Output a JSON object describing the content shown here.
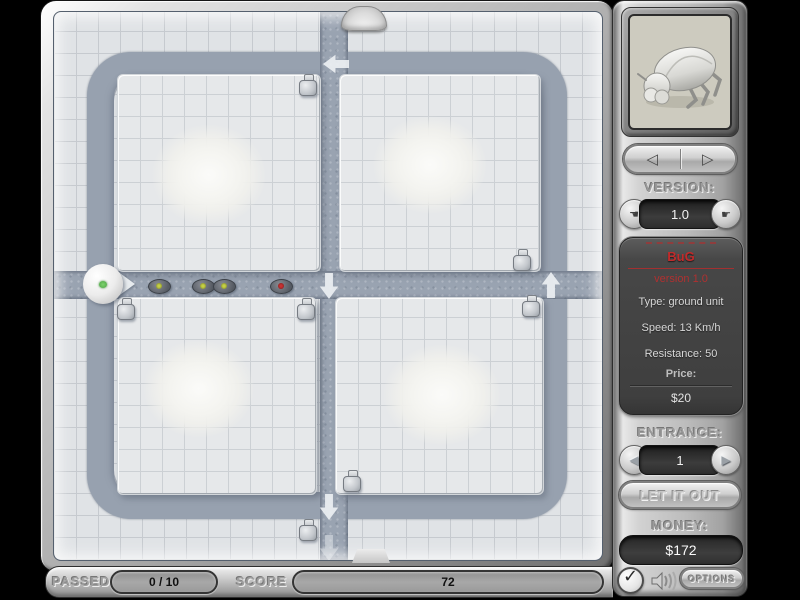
{
  "sidebar": {
    "preview_unit": "beetle",
    "nav": {
      "prev_symbol": "◁",
      "next_symbol": "▷"
    },
    "version_label": "VERSION:",
    "version_value": "1.0",
    "version_prev_symbol": "☚",
    "version_next_symbol": "☛",
    "unit_info": {
      "name": "BuG",
      "version_line": "version 1.0",
      "type_line": "Type: ground unit",
      "speed_line": "Speed: 13 Km/h",
      "resistance_line": "Resistance: 50",
      "price_label": "Price:",
      "price_value": "$20"
    },
    "entrance_label": "ENTRANCE:",
    "entrance_value": "1",
    "entrance_prev_symbol": "◀",
    "entrance_next_symbol": "▶",
    "release_button_label": "LET IT OUT",
    "money_label": "MONEY:",
    "money_value": "$172",
    "check_symbol": "✓",
    "options_button_label": "OPTIONS"
  },
  "status_bar": {
    "passed_label": "PASSED",
    "passed_value": "0 / 10",
    "score_label": "SCORE",
    "score_value": "72"
  },
  "colors": {
    "path": "#99a3b1",
    "tile": "#e0e3e6",
    "unit_name_red": "#c22b2b",
    "bug_dot_yellow": "#c9d447",
    "bug_dot_red": "#cc3333",
    "entrance_dot_green": "#5cc24e"
  },
  "board": {
    "turrets": [
      {
        "x": 244,
        "y": 62
      },
      {
        "x": 458,
        "y": 237
      },
      {
        "x": 467,
        "y": 283
      },
      {
        "x": 62,
        "y": 286
      },
      {
        "x": 242,
        "y": 286
      },
      {
        "x": 288,
        "y": 458
      },
      {
        "x": 244,
        "y": 507
      }
    ],
    "bugs": [
      {
        "x": 94,
        "y": 267,
        "dot": "#c9d447"
      },
      {
        "x": 138,
        "y": 267,
        "dot": "#c9d447"
      },
      {
        "x": 159,
        "y": 267,
        "dot": "#c9d447"
      },
      {
        "x": 216,
        "y": 267,
        "dot": "#cc3333"
      }
    ],
    "arrows": [
      {
        "x": 269,
        "y": 41,
        "dir": "left",
        "opacity": 0.9
      },
      {
        "x": 39,
        "y": 262,
        "dir": "right",
        "opacity": 0.9
      },
      {
        "x": 262,
        "y": 263,
        "dir": "down",
        "opacity": 0.9
      },
      {
        "x": 484,
        "y": 262,
        "dir": "up",
        "opacity": 0.9
      },
      {
        "x": 262,
        "y": 484,
        "dir": "down",
        "opacity": 0.9
      },
      {
        "x": 262,
        "y": 525,
        "dir": "down",
        "opacity": 0.45
      }
    ]
  }
}
